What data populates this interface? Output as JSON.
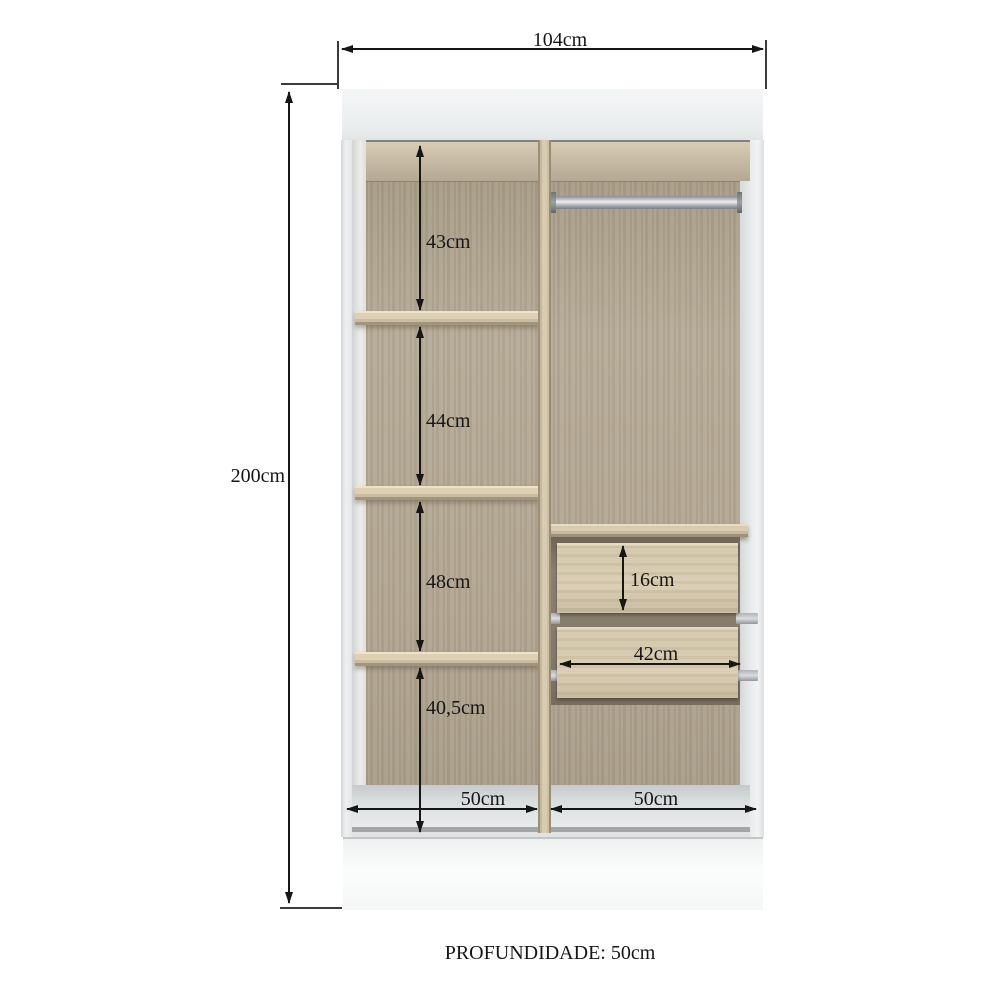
{
  "dimensions": {
    "overall_width": {
      "label": "104cm"
    },
    "overall_height": {
      "label": "200cm"
    },
    "left_column_sections": [
      {
        "label": "43cm"
      },
      {
        "label": "44cm"
      },
      {
        "label": "48cm"
      },
      {
        "label": "40,5cm"
      }
    ],
    "drawer": {
      "height_label": "16cm",
      "width_label": "42cm"
    },
    "bottom_columns": [
      {
        "label": "50cm"
      },
      {
        "label": "50cm"
      }
    ]
  },
  "footer": {
    "depth_label": "PROFUNDIDADE: 50cm"
  },
  "colors": {
    "background": "#ffffff",
    "cabinet_white": "#f2f4f5",
    "wood_back_panel": "#b1a591",
    "wood_shelf": "#d8cbb0",
    "wood_drawer_face": "#d5c8ac",
    "rod_metal": "#c6cacd",
    "floor_gray": "#dcdfe0",
    "dimension_ink": "#161616"
  }
}
